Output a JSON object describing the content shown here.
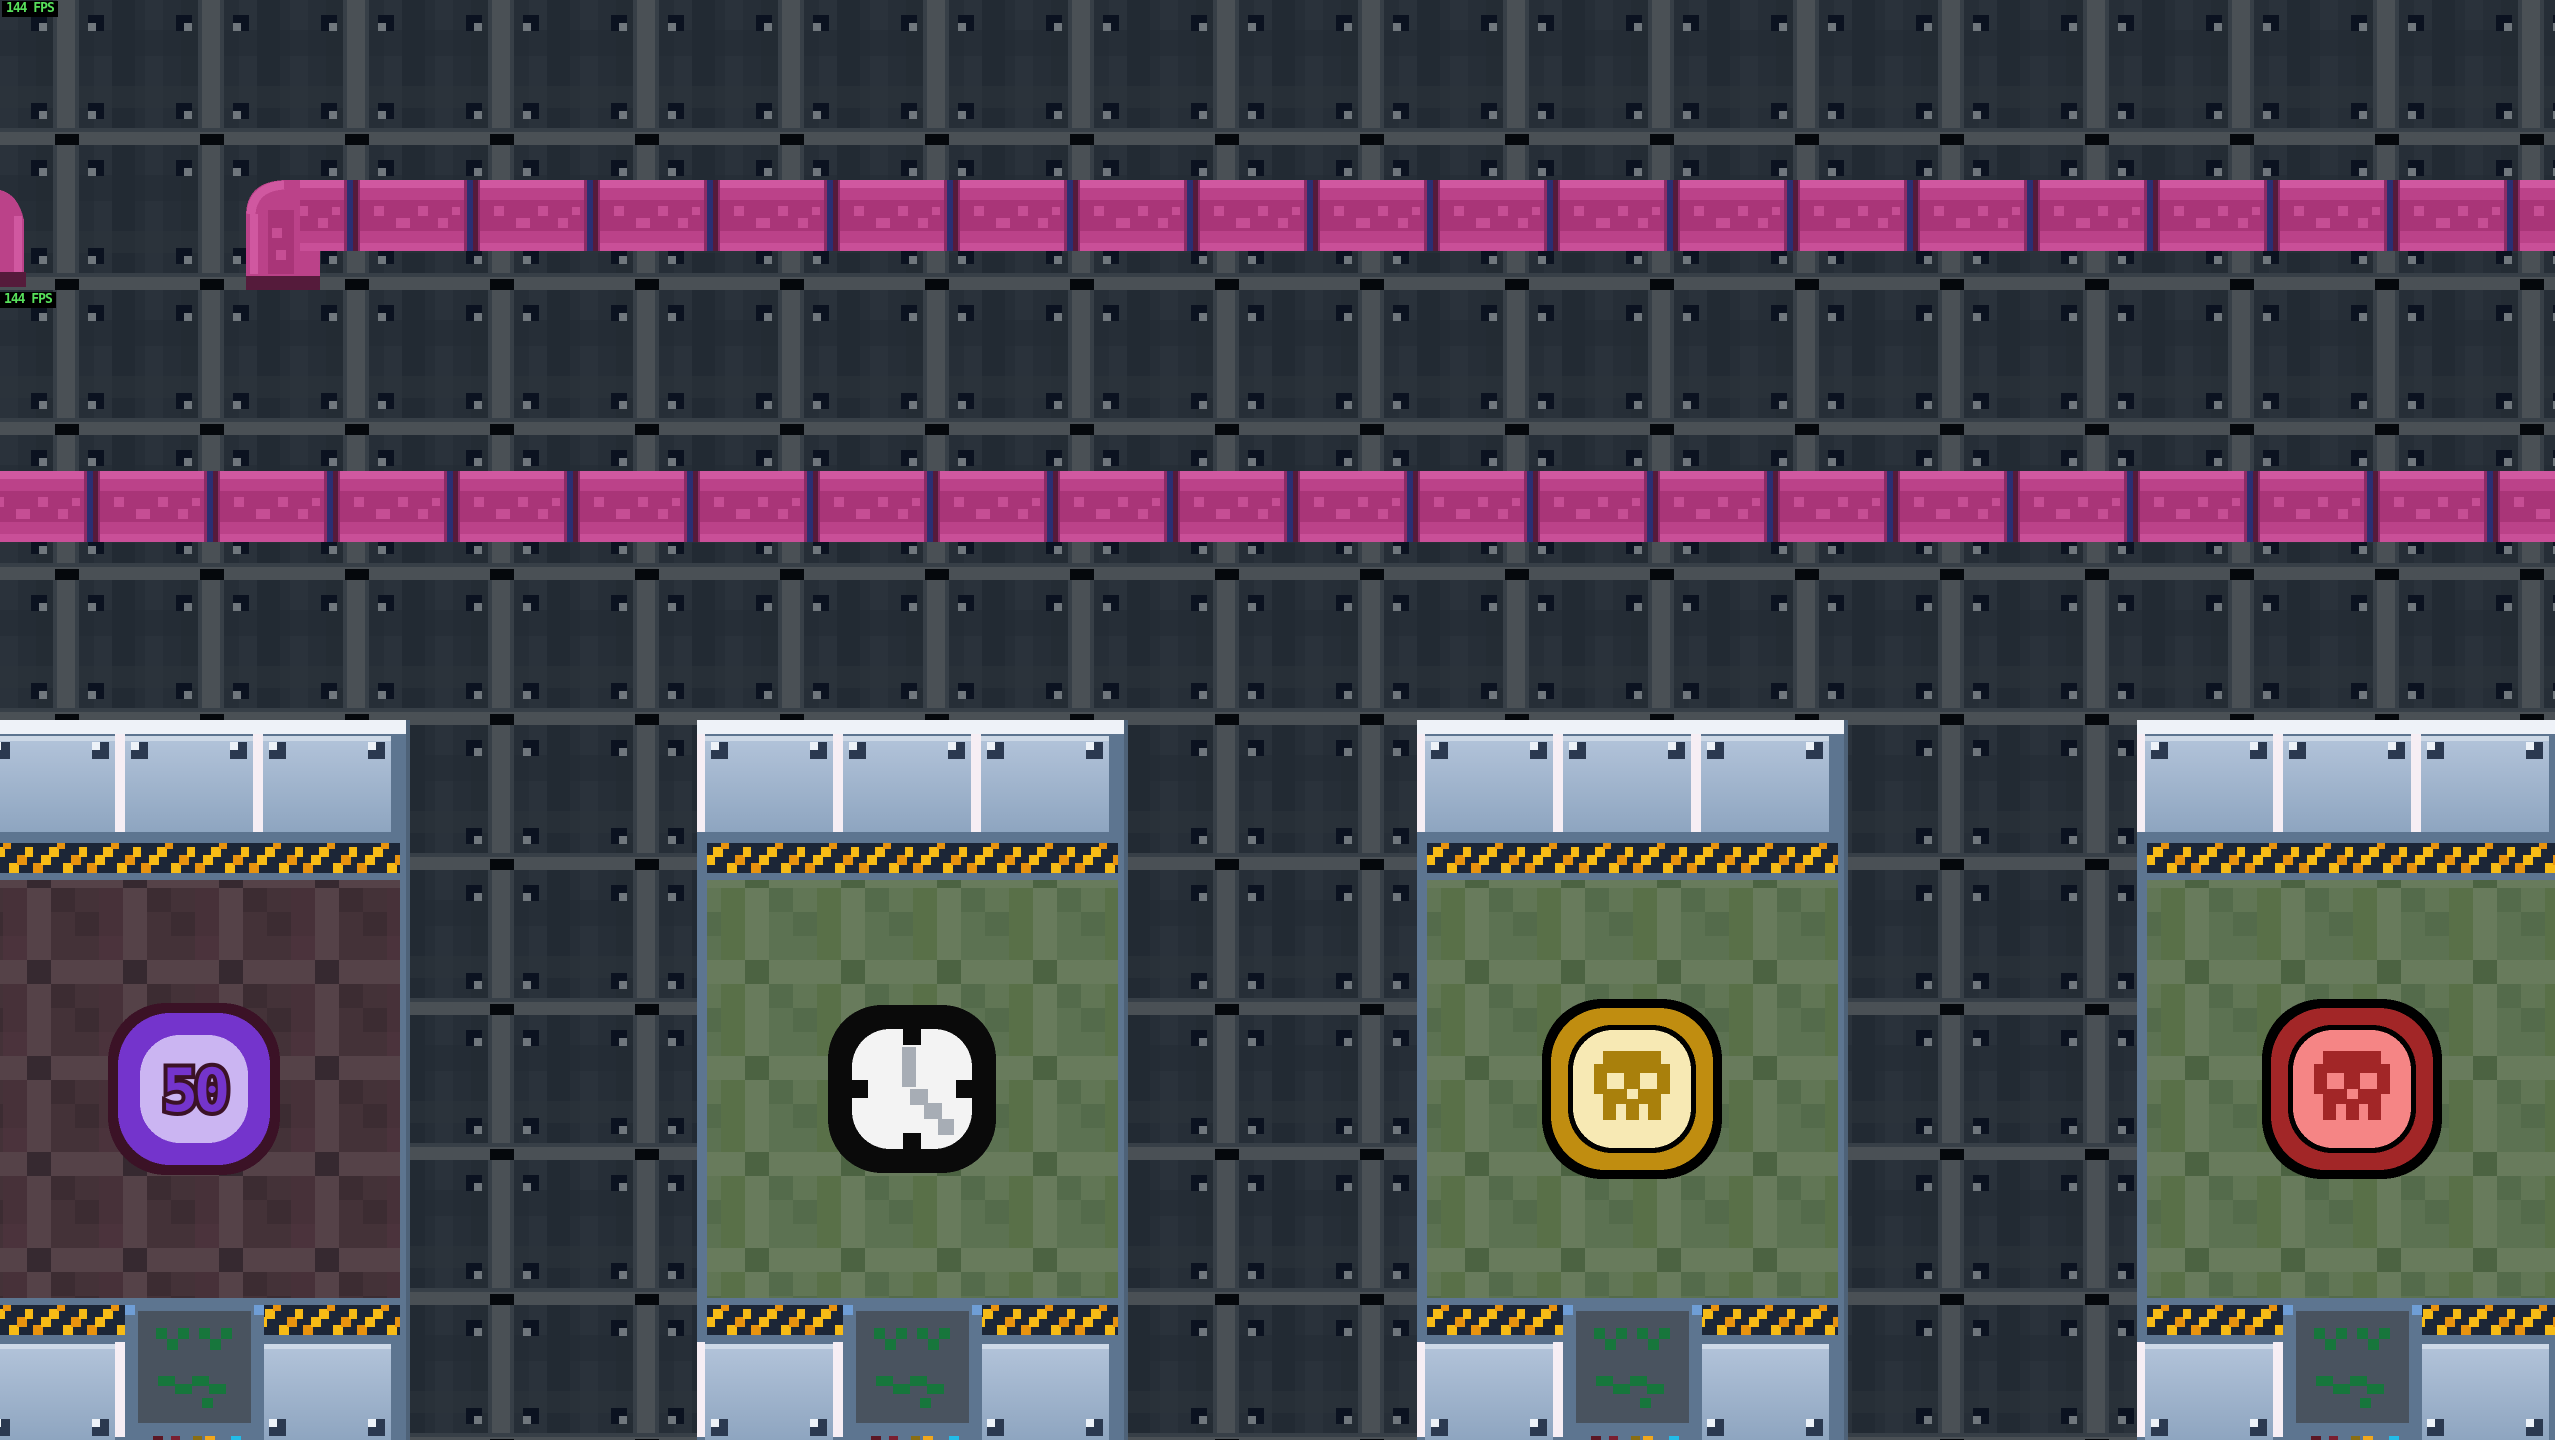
{
  "hud": {
    "fps_top": "144 FPS",
    "fps_mid": "144 FPS",
    "fps_color": "#57e05b",
    "fps_bg": "#000000"
  },
  "scene": {
    "wall_tile_color": "#262e37",
    "wall_stripe_color": "#4a5055",
    "pipe": {
      "body": "#b5408a",
      "highlight": "#d058a0",
      "shadow": "#a93578",
      "joint_maroon": "#551b3b",
      "joint_blue": "#2a2f72"
    },
    "hazard": {
      "bg": "#1c2637",
      "yellow": "#f7bb16",
      "orange": "#e8930f"
    },
    "panel": {
      "frame": "#5d7590",
      "plate_top": "#b3c4da",
      "plate_bottom": "#8ea5c0",
      "trim_white": "#eef2f8",
      "gap_white": "#f6eef4",
      "rivet": "#2b3950",
      "rivet_highlight": "#edf2f8",
      "vent_bg": "#49535f",
      "vent_face_green": "#17763c",
      "vent_corner_blue": "#6f9ed6"
    },
    "plaids": {
      "green": "#5c7252",
      "red": "#443238"
    }
  },
  "panels": [
    {
      "name": "door-panel-coin-50",
      "icon": "coin-50-icon",
      "label": "50",
      "backdrop": "red-plaid",
      "colors": {
        "ring": "#7434cc",
        "face": "#cbb5f2",
        "outline": "#3b1226"
      }
    },
    {
      "name": "door-panel-clock",
      "icon": "clock-icon",
      "backdrop": "green-plaid",
      "colors": {
        "ring": "#0a0a0a",
        "face": "#f3f3f3",
        "hands": "#a7adb5"
      }
    },
    {
      "name": "door-panel-skull-gold",
      "icon": "skull-gold-icon",
      "backdrop": "green-plaid",
      "colors": {
        "ring": "#c08d10",
        "face": "#f7e9b4",
        "glyph": "#a9800c"
      }
    },
    {
      "name": "door-panel-skull-red",
      "icon": "skull-red-icon",
      "backdrop": "green-plaid",
      "colors": {
        "ring": "#a22627",
        "face": "#f58585",
        "glyph": "#a22627"
      }
    }
  ]
}
